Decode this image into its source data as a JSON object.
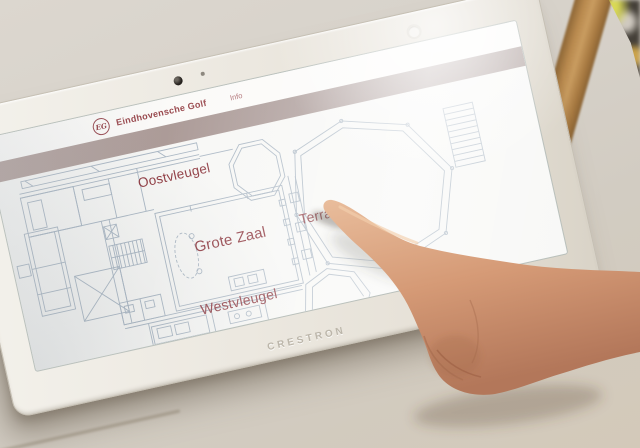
{
  "device": {
    "brand_label": "CRESTRON"
  },
  "screen": {
    "header": {
      "logo_monogram": "EG",
      "club_name": "Eindhovensche Golf",
      "secondary_label": "Info"
    },
    "floorplan": {
      "rooms": [
        {
          "label": "Oostvleugel"
        },
        {
          "label": "Grote Zaal"
        },
        {
          "label": "Terras"
        },
        {
          "label": "Westvleugel"
        }
      ]
    },
    "colors": {
      "accent": "#8e383f",
      "header_band": "#a89794",
      "plan_lines": "#a9b6c3"
    }
  },
  "icons": {
    "camera": "dot",
    "mic_hole": "dot",
    "light_sensor": "ring"
  }
}
